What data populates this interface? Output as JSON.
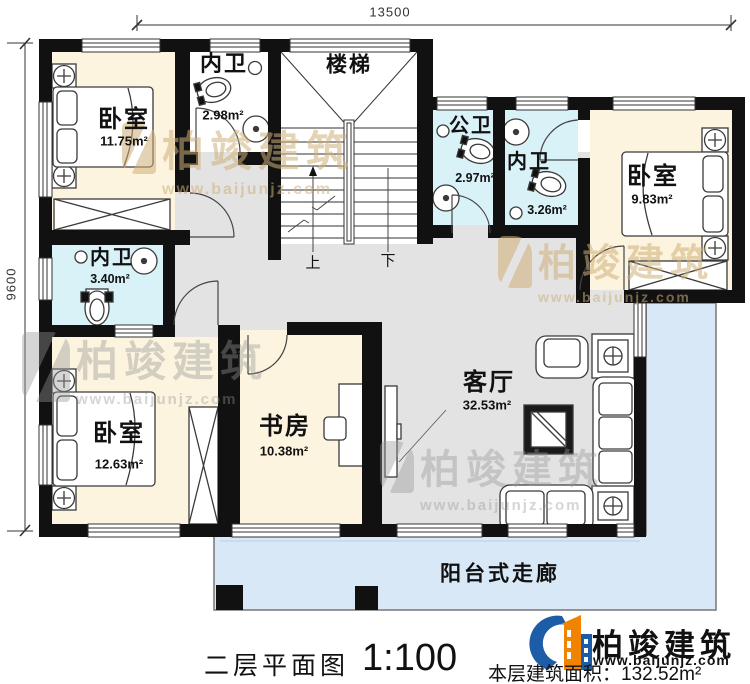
{
  "dimensions": {
    "top": "13500",
    "left": "9600"
  },
  "rooms": {
    "bedroom_top_left": {
      "name": "卧室",
      "area": "11.75m²"
    },
    "ensuite_top_left": {
      "name": "内卫",
      "area": "2.98m²"
    },
    "stairs": {
      "name": "楼梯",
      "up": "上",
      "down": "下"
    },
    "public_bath": {
      "name": "公卫",
      "area": "2.97m²"
    },
    "ensuite_top_right": {
      "name": "内卫",
      "area": "3.26m²"
    },
    "bedroom_top_right": {
      "name": "卧室",
      "area": "9.83m²"
    },
    "ensuite_mid_left": {
      "name": "内卫",
      "area": "3.40m²"
    },
    "bedroom_bottom_left": {
      "name": "卧室",
      "area": "12.63m²"
    },
    "study": {
      "name": "书房",
      "area": "10.38m²"
    },
    "living": {
      "name": "客厅",
      "area": "32.53m²"
    },
    "balcony": {
      "name": "阳台式走廊"
    }
  },
  "footer": {
    "plan_title": "二层平面图",
    "scale": "1:100",
    "floor_area": "本层建筑面积：132.52m²"
  },
  "brand": {
    "name": "柏竣建筑",
    "website": "www.baijunjz.com"
  },
  "watermark": {
    "text": "柏竣建筑",
    "website": "www.baijunjz.com"
  },
  "colors": {
    "wall": "#111111",
    "bedroom_fill": "#fcf4df",
    "bath_fill": "#d9f2f7",
    "hall_fill": "#e3e3e3",
    "balcony_fill": "#d9e8f7",
    "brand_blue": "#1d5ca6",
    "brand_orange": "#f08300"
  }
}
